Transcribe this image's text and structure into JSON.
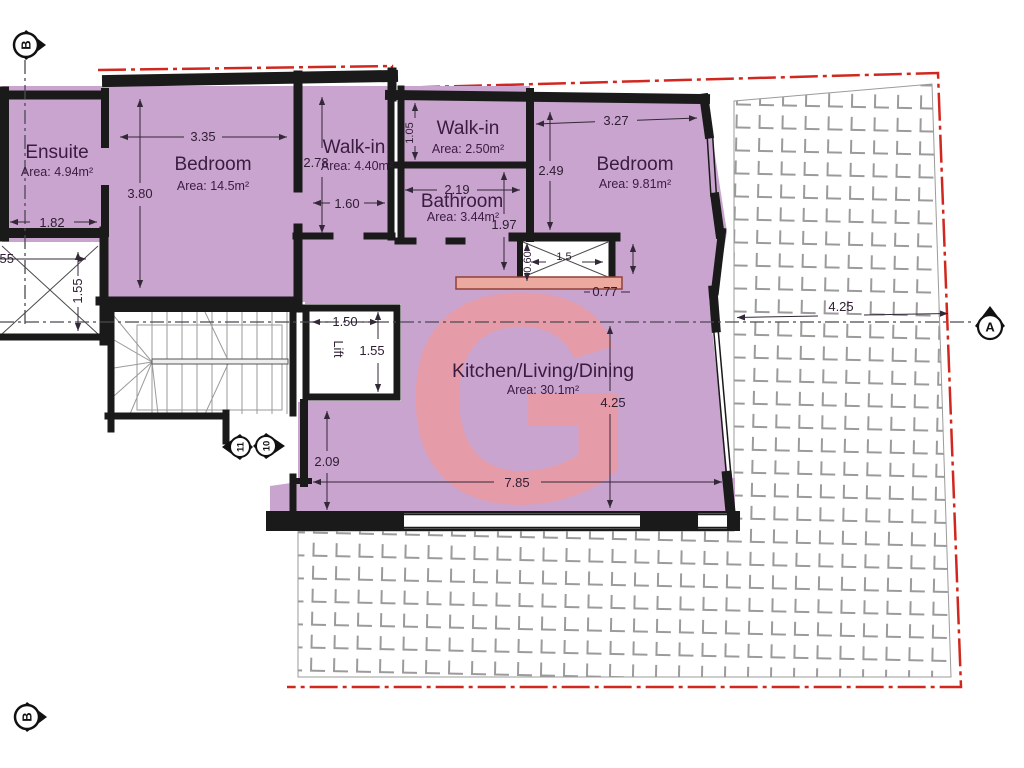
{
  "plan": {
    "watermark": "G",
    "rooms": {
      "ensuite": {
        "name": "Ensuite",
        "area": "Area: 4.94m²"
      },
      "bedroom1": {
        "name": "Bedroom",
        "area": "Area: 14.5m²"
      },
      "walkin1": {
        "name": "Walk-in",
        "area": "Area: 4.40m²"
      },
      "walkin2": {
        "name": "Walk-in",
        "area": "Area: 2.50m²"
      },
      "bathroom": {
        "name": "Bathroom",
        "area": "Area: 3.44m²"
      },
      "bedroom2": {
        "name": "Bedroom",
        "area": "Area: 9.81m²"
      },
      "kitchen": {
        "name": "Kitchen/Living/Dining",
        "area": "Area: 30.1m²"
      },
      "lift": {
        "name": "Lift"
      }
    },
    "dims": {
      "bedroom1_width": "3.35",
      "bedroom1_height": "3.80",
      "ensuite_width": "1.82",
      "shaft_left_width": "1.55",
      "shaft_left_height": "1.55",
      "walkin1_height": "2.78",
      "walkin1_width": "1.60",
      "walkin2_height": "1.05",
      "bathroom_width": "2.19",
      "bathroom_height": "1.97",
      "bedroom2_height": "2.49",
      "bedroom2_width": "3.27",
      "shaft_mid_width": "1.5",
      "shaft_mid_height": "0.60",
      "shaft_mid_gap": "0.77",
      "lift_width": "1.50",
      "lift_height": "1.55",
      "kitchen_side": "2.09",
      "kitchen_width": "7.85",
      "kitchen_height": "4.25",
      "terrace_width": "4.25"
    },
    "markers": {
      "section_b_top": "B",
      "section_b_bottom": "B",
      "section_a": "A",
      "stair_count_up": "11",
      "stair_count_down": "10"
    },
    "colors": {
      "room_fill": "#c9a4ce",
      "wall": "#1a1a1a",
      "boundary": "#d0281f",
      "watermark": "#f0999d",
      "tile_line": "#9b9b9b",
      "dim_text": "#2e1d33",
      "accent_wall_fill": "#eba99f",
      "accent_wall_stroke": "#8f4038"
    }
  }
}
